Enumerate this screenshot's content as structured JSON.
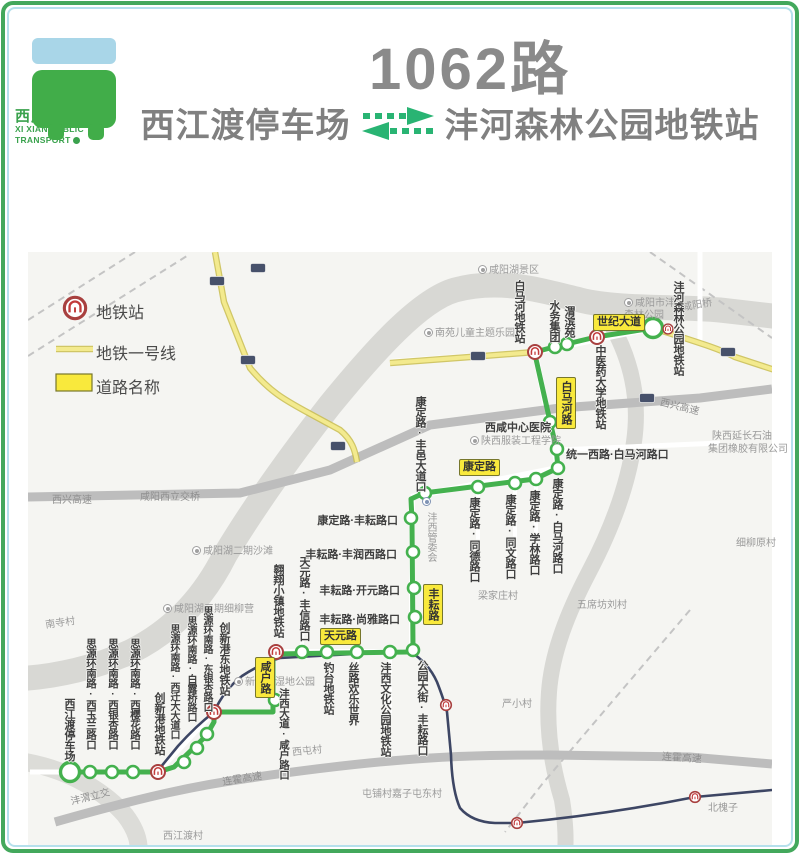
{
  "header": {
    "brand_cn": "西咸公交",
    "brand_en_1": "XI XIAN PUBLIC",
    "brand_en_2": "TRANSPORT",
    "route_number": "1062路",
    "origin": "西江渡停车场",
    "destination": "沣河森林公园地铁站"
  },
  "legend": {
    "metro_station": "地铁站",
    "metro_line": "地铁一号线",
    "road_name": "道路名称"
  },
  "map": {
    "stations": [
      "西江渡停车场",
      "思源环南路·西玉兰路口",
      "思源环南路·西银杏路口",
      "思源环南路·西樱花路口",
      "创新港地铁站",
      "思源环南路·西迁大大道口",
      "思源环南路·白露桥路口",
      "思源环南路·东银杏路口",
      "创新港东地铁站",
      "沣西大道·咸户路口",
      "翱翔小镇地铁站",
      "天元路·丰信路口",
      "钓台地铁站",
      "丝路欢乐世界",
      "沣西文化公园地铁站",
      "公园大街·丰耘路口",
      "丰耘路·尚雅路口",
      "丰耘路·开元路口",
      "丰耘路·丰润西路口",
      "康定路·丰耘路口",
      "康定路·丰邑大道口",
      "康定路·同德路口",
      "康定路·同文路口",
      "康定路·学林路口",
      "康定路·白马河路口",
      "统一西路·白马河路口",
      "西咸中心医院",
      "白马河地铁站",
      "水务集团",
      "渭滨苑",
      "中医药大学地铁站",
      "沣河森林公园地铁站"
    ],
    "badges": [
      "世纪大道",
      "白马河路",
      "康定路",
      "丰耘路",
      "天元路",
      "咸户路"
    ],
    "places": [
      "咸阳湖景区",
      "咸阳桥",
      "南苑儿童主题乐园",
      "咸阳市沣河森林公园",
      "陕西延长石油",
      "集团橡胶有限公司",
      "陕西服装工程学院",
      "沣西管委会",
      "梁家庄村",
      "五席坊刘村",
      "细柳原村",
      "严小村",
      "西屯村",
      "新渭沙湿地公园",
      "咸阳湖二期沙滩",
      "咸阳湖三期细柳营",
      "南寺村",
      "屯铺村嘉子屯东村",
      "北槐子",
      "西江渡村"
    ],
    "roads": [
      "西兴高速",
      "咸阳西立交桥",
      "西兴高速",
      "连霍高速",
      "连霍高速",
      "沣渭立交"
    ]
  },
  "colors": {
    "route_green": "#44b14e",
    "metro_line_yellow": "#f3ea8e",
    "road_badge_yellow": "#f9e93c",
    "brand_green": "#3aa24d",
    "metro_icon_red": "#b04341",
    "frame_green": "#43a85c"
  }
}
